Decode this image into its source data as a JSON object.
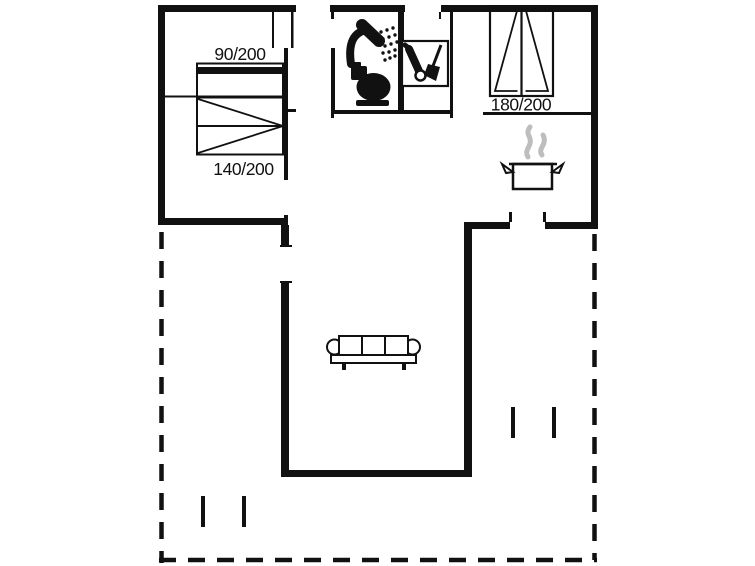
{
  "floorplan": {
    "background": "#ffffff",
    "ink": "#111111",
    "steam_color": "#bdbdbd",
    "labels": {
      "bed_90": "90/200",
      "bed_140": "140/200",
      "bed_180": "180/200"
    },
    "rooms": {
      "bedroom_left_beds": [
        "90/200",
        "140/200"
      ],
      "bedroom_right_bed": "180/200"
    },
    "icons": [
      "shower-icon",
      "toilet-icon",
      "vacuum-broom-icon",
      "cooking-pot-icon",
      "steam-icon",
      "sofa-icon",
      "bed-icon",
      "terrace-dashed-boundary"
    ]
  }
}
